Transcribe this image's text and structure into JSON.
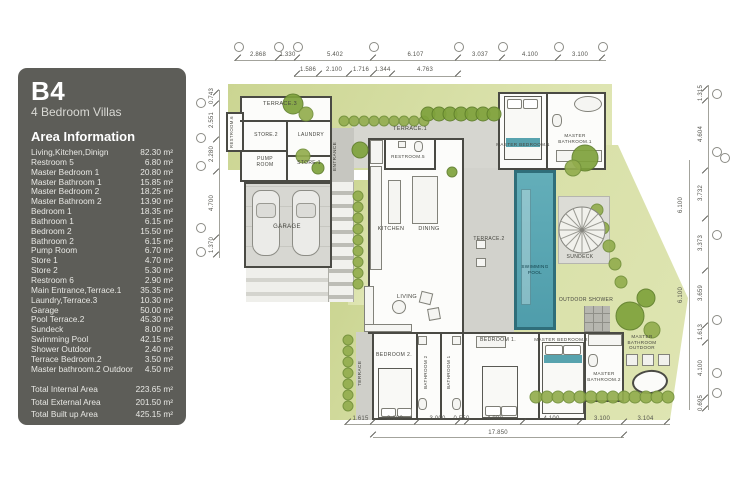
{
  "panel": {
    "title": "B4",
    "subtitle": "4 Bedroom Villas",
    "section_heading": "Area Information",
    "areas": [
      {
        "label": "Living,Kitchen,Dinign",
        "value": "82.30 m²"
      },
      {
        "label": "Restroom 5",
        "value": "6.80 m²"
      },
      {
        "label": "Master Bedroom 1",
        "value": "20.80 m²"
      },
      {
        "label": "Master Bathroom 1",
        "value": "15.85 m²"
      },
      {
        "label": "Master Bedroom 2",
        "value": "18.25 m²"
      },
      {
        "label": "Master Bathroom 2",
        "value": "13.90 m²"
      },
      {
        "label": "Bedroom 1",
        "value": "18.35 m²"
      },
      {
        "label": "Bathroom 1",
        "value": "6.15 m²"
      },
      {
        "label": "Bedroom 2",
        "value": "15.50 m²"
      },
      {
        "label": "Bathroom 2",
        "value": "6.15 m²"
      },
      {
        "label": "Pump Room",
        "value": "6.70 m²"
      },
      {
        "label": "Store 1",
        "value": "4.70 m²"
      },
      {
        "label": "Store 2",
        "value": "5.30 m²"
      },
      {
        "label": "Restroom 6",
        "value": "2.90 m²"
      },
      {
        "label": "Main Entrance,Terrace.1",
        "value": "35.35 m²"
      },
      {
        "label": "Laundry,Terrace.3",
        "value": "10.30 m²"
      },
      {
        "label": "Garage",
        "value": "50.00 m²"
      },
      {
        "label": "Pool Terrace.2",
        "value": "45.30 m²"
      },
      {
        "label": "Sundeck",
        "value": "8.00 m²"
      },
      {
        "label": "Swimming Pool",
        "value": "42.15 m²"
      },
      {
        "label": "Shower Outdoor",
        "value": "2.40 m²"
      },
      {
        "label": "Terrace Bedroom.2",
        "value": "3.50 m²"
      },
      {
        "label": "Master bathroom.2 Outdoor",
        "value": "4.50 m²"
      }
    ],
    "totals": [
      {
        "label": "Total Internal Area",
        "value": "223.65 m²"
      },
      {
        "label": "Total External Area",
        "value": "201.50 m²"
      },
      {
        "label": "Total Built up Area",
        "value": "425.15 m²"
      }
    ]
  },
  "plan": {
    "rooms": {
      "terrace3": "TERRACE.3",
      "restroom6": "RESTROOM.6",
      "store2": "STORE.2",
      "laundry": "LAUNDRY",
      "pump_room": "PUMP ROOM",
      "store1": "STORE.1",
      "entrance": "ENTRANCE",
      "garage": "GARAGE",
      "kitchen": "KITCHEN",
      "dining": "DINING",
      "living": "LIVING",
      "restroom5": "RESTROOM.5",
      "terrace1": "TERRACE.1",
      "master_bedroom1": "MASTER BEDROOM.1",
      "master_bathroom1": "MASTER BATHROOM.1",
      "terrace2": "TERRACE.2",
      "swimming_pool": "SWIMMING POOL",
      "sundeck": "SUNDECK",
      "outdoor_shower": "OUTDOOR SHOWER",
      "terrace": "TERRACE",
      "bedroom2": "BEDROOM 2.",
      "bathroom2": "BATHROOM 2",
      "bathroom1": "BATHROOM 1",
      "bedroom1": "BEDROOM 1.",
      "master_bedroom2": "MASTER BEDROOM.2",
      "master_bathroom2": "MASTER BATHROOM.2",
      "master_bathroom_outdoor": "MASTER BATHROOM OUTDOOR"
    },
    "dims": {
      "top_row1": [
        "2.868",
        "1.330",
        "5.402",
        "6.107",
        "3.037",
        "4.100",
        "3.100"
      ],
      "top_row2": [
        "1.586",
        "2.100",
        "1.716",
        "1.344",
        "4.763"
      ],
      "bottom": [
        "1.615",
        "3.100",
        "3.000",
        "0.550",
        "4.000",
        "4.100",
        "3.100",
        "3.104"
      ],
      "bottom_total": "17.850",
      "left": [
        "0.743",
        "2.551",
        "2.280",
        "4.700",
        "1.370"
      ],
      "right": [
        "1.315",
        "4.604",
        "3.732",
        "3.373",
        "3.659",
        "1.613",
        "4.100",
        "0.695"
      ],
      "right_inner": [
        "6.100",
        "6.100"
      ]
    },
    "colors": {
      "panel": "#5d5d58",
      "landscape_green": "#cdd79b",
      "pool": "#5aa7b3",
      "teal_accent": "#58a3ae"
    }
  }
}
